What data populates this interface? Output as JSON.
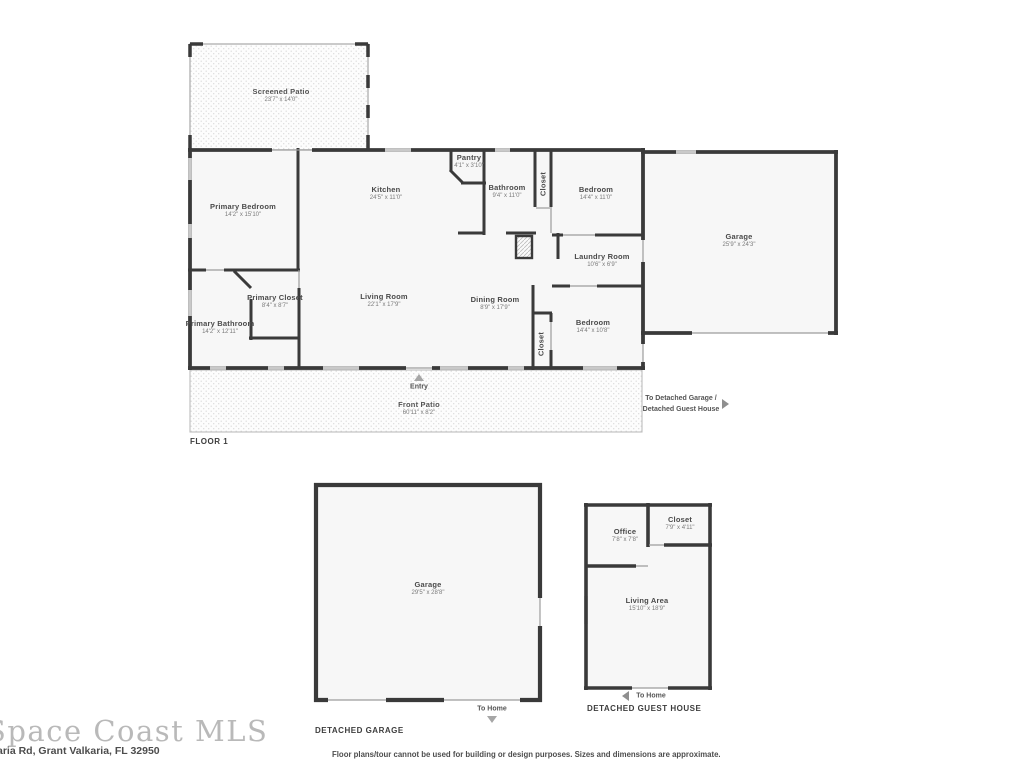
{
  "floor1": {
    "title": "FLOOR 1",
    "rooms": [
      {
        "name": "Screened Patio",
        "dims": "23'7\" x 14'0\""
      },
      {
        "name": "Primary Bedroom",
        "dims": "14'2\" x 15'10\""
      },
      {
        "name": "Kitchen",
        "dims": "24'5\" x 11'0\""
      },
      {
        "name": "Pantry",
        "dims": "4'1\" x 3'10\""
      },
      {
        "name": "Bathroom",
        "dims": "9'4\" x 11'0\""
      },
      {
        "name": "Closet",
        "dims": ""
      },
      {
        "name": "Bedroom",
        "dims": "14'4\" x 11'0\""
      },
      {
        "name": "Garage",
        "dims": "25'9\" x 24'3\""
      },
      {
        "name": "Laundry Room",
        "dims": "10'6\" x 6'9\""
      },
      {
        "name": "Primary Closet",
        "dims": "8'4\" x 8'7\""
      },
      {
        "name": "Primary Bathroom",
        "dims": "14'2\" x 12'11\""
      },
      {
        "name": "Living Room",
        "dims": "22'1\" x 17'9\""
      },
      {
        "name": "Dining Room",
        "dims": "8'9\" x 17'9\""
      },
      {
        "name": "Closet",
        "dims": ""
      },
      {
        "name": "Bedroom",
        "dims": "14'4\" x 10'8\""
      },
      {
        "name": "Front Patio",
        "dims": "60'11\" x 8'2\""
      }
    ],
    "entry_label": "Entry",
    "to_detached_line1": "To Detached Garage /",
    "to_detached_line2": "Detached Guest House"
  },
  "detached_garage": {
    "title": "DETACHED GARAGE",
    "room": {
      "name": "Garage",
      "dims": "29'5\" x 28'8\""
    },
    "to_home": "To Home"
  },
  "guest_house": {
    "title": "DETACHED GUEST HOUSE",
    "rooms": [
      {
        "name": "Office",
        "dims": "7'8\" x 7'8\""
      },
      {
        "name": "Closet",
        "dims": "7'9\" x 4'11\""
      },
      {
        "name": "Living Area",
        "dims": "15'10\" x 18'9\""
      }
    ],
    "to_home": "To Home"
  },
  "footer": {
    "watermark": "Space Coast MLS",
    "address": "aria Rd, Grant Valkaria, FL 32950",
    "disclaimer": "Floor plans/tour cannot be used for building or design purposes. Sizes and dimensions are approximate."
  }
}
